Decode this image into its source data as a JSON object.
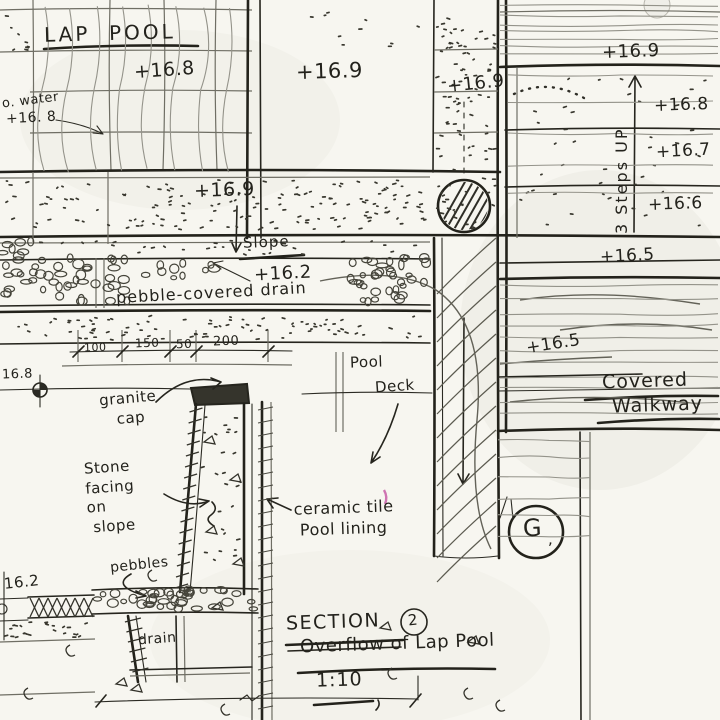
{
  "sheet": {
    "drawing_type": "hand-drawn pool construction sketch"
  },
  "plan": {
    "lap_pool_label": "LAP  POOL",
    "lap_pool_level": "+16.8",
    "overflow_water_note": "o. water",
    "overflow_water_level": "+16. 8",
    "deck_level_a": "+16.9",
    "deck_level_b": "+16.9",
    "deck_level_c": "+16.9",
    "slope_label": "Slope",
    "drain_level": "+16.2",
    "drain_note": "pebble-covered drain",
    "pool_deck_line1": "Pool",
    "pool_deck_line2": "Deck",
    "datum_upper": "16.8",
    "dim_values": [
      "100",
      "150",
      "50",
      "200"
    ]
  },
  "steps": {
    "top_level": "+16.9",
    "note": "3 Steps UP",
    "levels": [
      "+16.8",
      "+16.7",
      "+16.6"
    ]
  },
  "walkway": {
    "level_a": "+16.5",
    "level_b": "+16.5",
    "name_line1": "Covered",
    "name_line2": "Walkway"
  },
  "section_detail": {
    "granite_cap_note": "granite\n   cap",
    "stone_facing_note": "Stone\nfacing\non\n slope",
    "tile_note": "ceramic tile\n Pool lining",
    "pebbles_note": "pebbles",
    "drain_note": "drain",
    "datum_lower": "16.2"
  },
  "references": {
    "grid_bubble": "G",
    "grid_bubble_suffix": ",",
    "section_label": "SECTION",
    "section_number": "2",
    "section_subtitle": "Overflow of Lap Pool",
    "scale": "1:10"
  }
}
